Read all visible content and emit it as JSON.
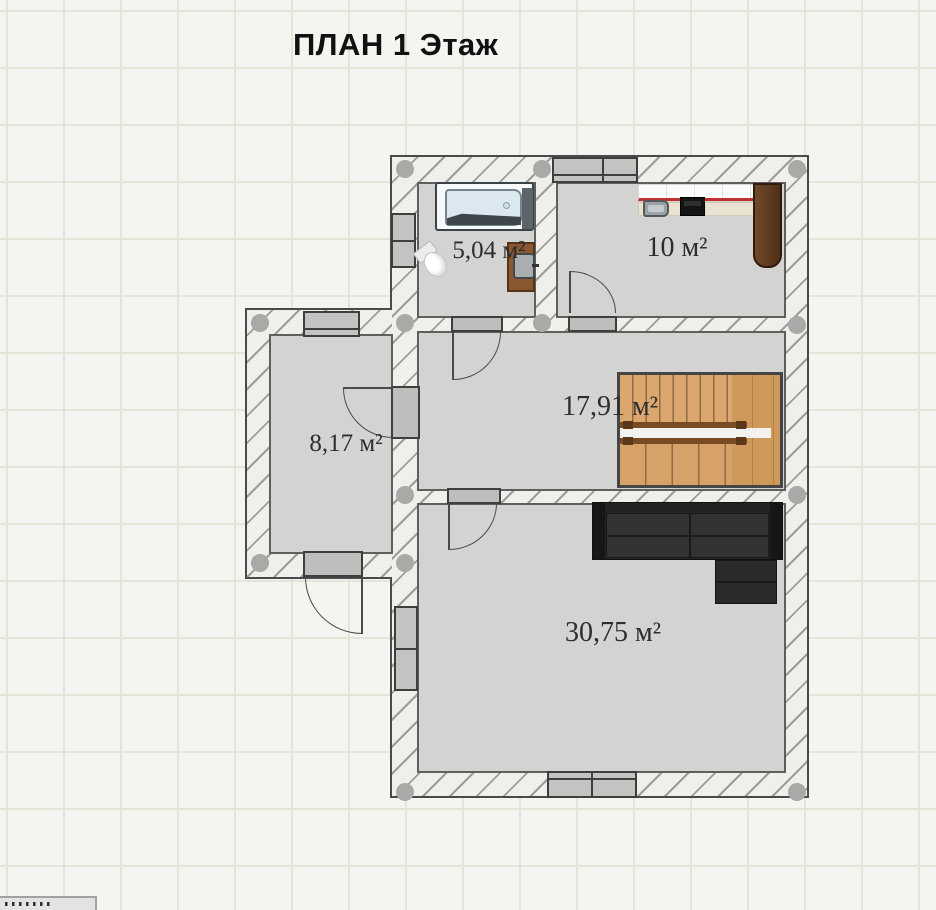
{
  "page": {
    "title": "ПЛАН 1 Этаж"
  },
  "rooms": [
    {
      "id": "bathroom",
      "area_label": "5,04 м²"
    },
    {
      "id": "kitchen",
      "area_label": "10 м²"
    },
    {
      "id": "hall-stairs",
      "area_label": "17,91 м²"
    },
    {
      "id": "annex-room",
      "area_label": "8,17 м²"
    },
    {
      "id": "living-room",
      "area_label": "30,75 м²"
    }
  ],
  "palette": {
    "background": "#f4f4f1",
    "grid_line": "#e4e4d9",
    "wall_fill": "#efefec",
    "wall_hatch": "#9c9c99",
    "floor": "#d3d3d1",
    "stairs_wood": "#d9a66c",
    "handrail_brown": "#7a4c26",
    "sofa_dark": "#232323",
    "counter_edge_red": "#c03030",
    "title_color": "#111111",
    "label_color": "#2d2d2d"
  },
  "icons": {
    "corner_dots": "dots-icon"
  }
}
